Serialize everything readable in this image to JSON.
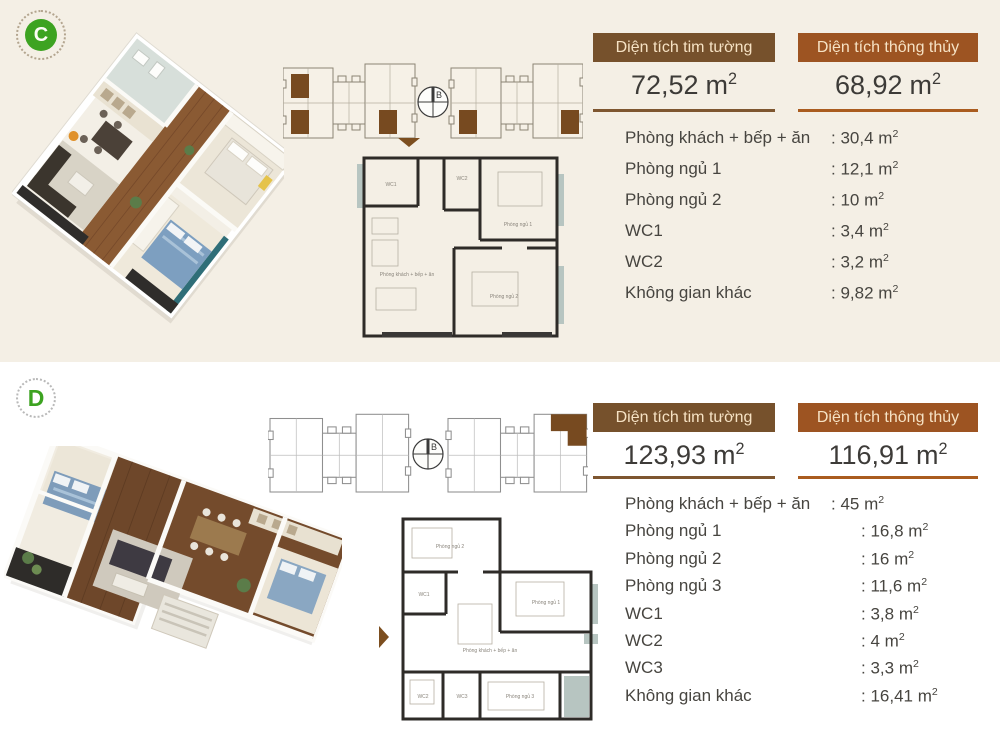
{
  "page": {
    "background_top": "#f4efe5",
    "background_bottom": "#ffffff"
  },
  "units": {
    "base": "m",
    "exp": "2"
  },
  "colon": ":",
  "compass_label": "B",
  "colors": {
    "accent_brown": "#76512c",
    "accent_orange": "#9d5422",
    "accent_green": "#3da321",
    "highlight_unit_brown": "#774a20",
    "section_c_background": "#f4efe5",
    "section_d_background": "#ffffff"
  },
  "sections": [
    {
      "badge": "C",
      "metrics": [
        {
          "title": "Diện tích tim tường",
          "value": "72,52"
        },
        {
          "title": "Diện tích thông thủy",
          "value": "68,92"
        }
      ],
      "rooms": [
        {
          "label": "Phòng khách + bếp + ăn",
          "value": "30,4"
        },
        {
          "label": "Phòng ngủ 1",
          "value": "12,1"
        },
        {
          "label": "Phòng ngủ 2",
          "value": "10"
        },
        {
          "label": "WC1",
          "value": "3,4"
        },
        {
          "label": "WC2",
          "value": "3,2"
        },
        {
          "label": "Không gian khác",
          "value": "9,82"
        }
      ]
    },
    {
      "badge": "D",
      "metrics": [
        {
          "title": "Diện tích tim tường",
          "value": "123,93"
        },
        {
          "title": "Diện tích thông thủy",
          "value": "116,91"
        }
      ],
      "rooms": [
        {
          "label": "Phòng khách + bếp + ăn",
          "value": "45"
        },
        {
          "label": "Phòng ngủ 1",
          "value": "16,8"
        },
        {
          "label": "Phòng ngủ 2",
          "value": "16"
        },
        {
          "label": "Phòng ngủ 3",
          "value": "11,6"
        },
        {
          "label": "WC1",
          "value": "3,8"
        },
        {
          "label": "WC2",
          "value": "4"
        },
        {
          "label": "WC3",
          "value": "3,3"
        },
        {
          "label": "Không gian khác",
          "value": "16,41"
        }
      ]
    }
  ]
}
